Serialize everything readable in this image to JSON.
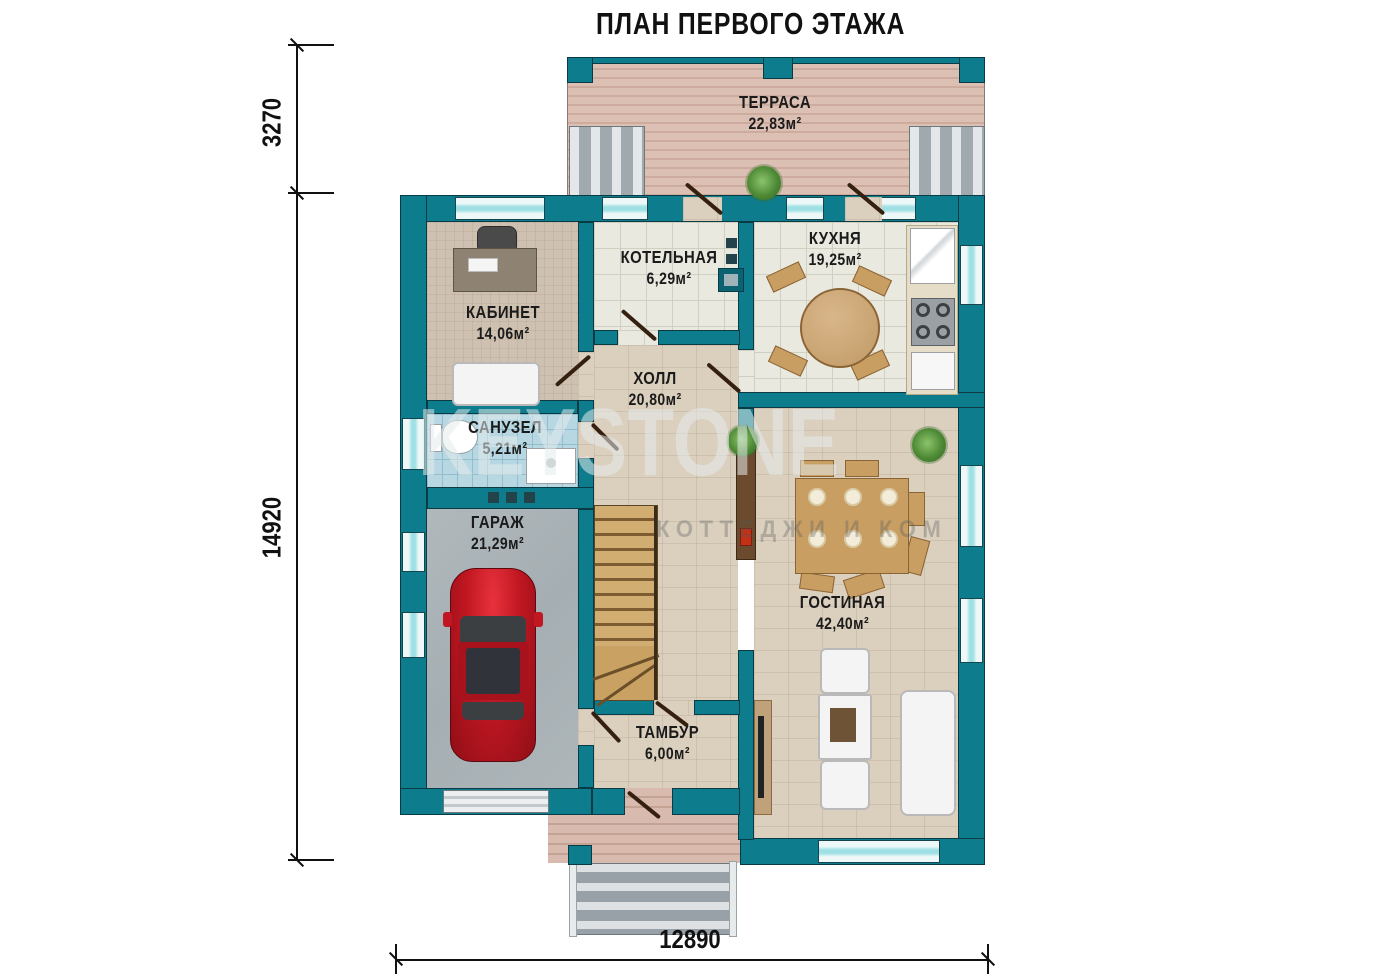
{
  "title": "ПЛАН ПЕРВОГО ЭТАЖА",
  "watermark": {
    "text": "KEYSTONE",
    "subtext": "КОТТЕДЖИ И КОМ"
  },
  "dimensions": {
    "terrace_depth": "3270",
    "house_depth": "14920",
    "house_width": "12890"
  },
  "rooms": [
    {
      "name": "ТЕРРАСА",
      "area": "22,83м²"
    },
    {
      "name": "КОТЕЛЬНАЯ",
      "area": "6,29м²"
    },
    {
      "name": "КУХНЯ",
      "area": "19,25м²"
    },
    {
      "name": "КАБИНЕТ",
      "area": "14,06м²"
    },
    {
      "name": "ХОЛЛ",
      "area": "20,80м²"
    },
    {
      "name": "САНУЗЕЛ",
      "area": "5,21м²"
    },
    {
      "name": "ГАРАЖ",
      "area": "21,29м²"
    },
    {
      "name": "ГОСТИНАЯ",
      "area": "42,40м²"
    },
    {
      "name": "ТАМБУР",
      "area": "6,00м²"
    }
  ],
  "colors": {
    "wall": "#0d7c8c",
    "window_glass": "#9fe0e4",
    "car": "#c01722"
  }
}
